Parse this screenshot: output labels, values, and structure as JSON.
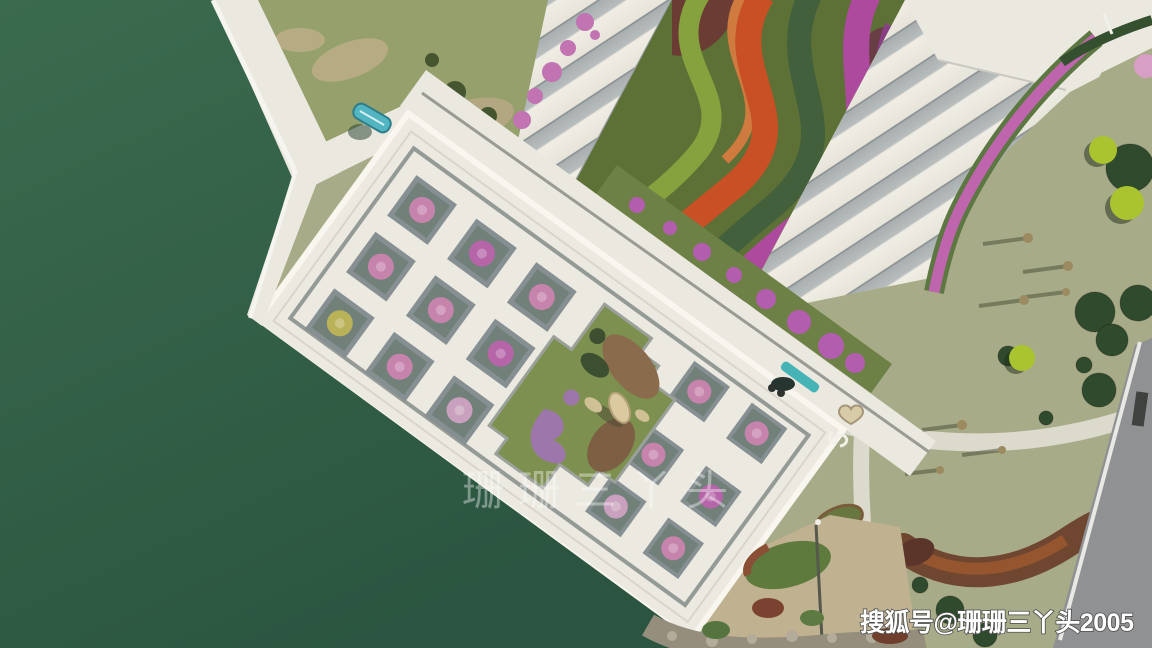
{
  "watermarks": {
    "center_faint": "珊珊三丫头",
    "bottom_right": "搜狐号@珊珊三丫头2005"
  },
  "palette": {
    "lawn": "#a8ab88",
    "water": "#336149",
    "plaza_stone": "#ece9e1",
    "concrete": "#ebe8e0",
    "terrace_green": "#5d7036",
    "slope_green": "#6d8146",
    "sand": "#c0b291",
    "road": "#8f9193",
    "watermark_white": "#ffffff"
  }
}
